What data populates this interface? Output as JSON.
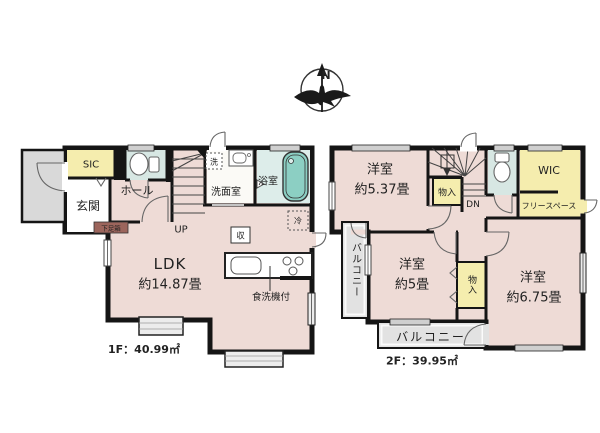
{
  "page": {
    "background": "#ffffff"
  },
  "compass": {
    "label": "N"
  },
  "palette": {
    "wall": "#151515",
    "room_pink": "#eedbd6",
    "closet_yellow": "#f5edae",
    "wet_blue": "#d7e7e3",
    "bath_blue": "#ddedea",
    "tub_teal": "#8ccfc3",
    "balcony_gray": "#e2e2e2",
    "shoe_brown": "#9c655c"
  },
  "floor1": {
    "area_label": "1F：40.99㎡",
    "labels": {
      "sic": "SIC",
      "entrance": "玄関",
      "hall": "ホール",
      "shoe_box": "下足箱",
      "washroom": "洗面室",
      "bathroom": "浴室",
      "washer": "洗",
      "fridge": "冷",
      "storage": "収",
      "stairs_up": "UP",
      "ldk_name": "LDK",
      "ldk_size": "約14.87畳",
      "dishwasher": "食洗機付"
    }
  },
  "floor2": {
    "area_label": "2F：39.95㎡",
    "labels": {
      "bedroom1_name": "洋室",
      "bedroom1_size": "約5.37畳",
      "closet_upper": "物入",
      "stairs_down": "DN",
      "wic": "WIC",
      "free_space": "フリースペース",
      "balcony_left": "バルコニー",
      "bedroom2_name": "洋室",
      "bedroom2_size": "約5畳",
      "closet_mid": "物入",
      "bedroom3_name": "洋室",
      "bedroom3_size": "約6.75畳",
      "balcony_bottom": "バルコニー"
    }
  }
}
